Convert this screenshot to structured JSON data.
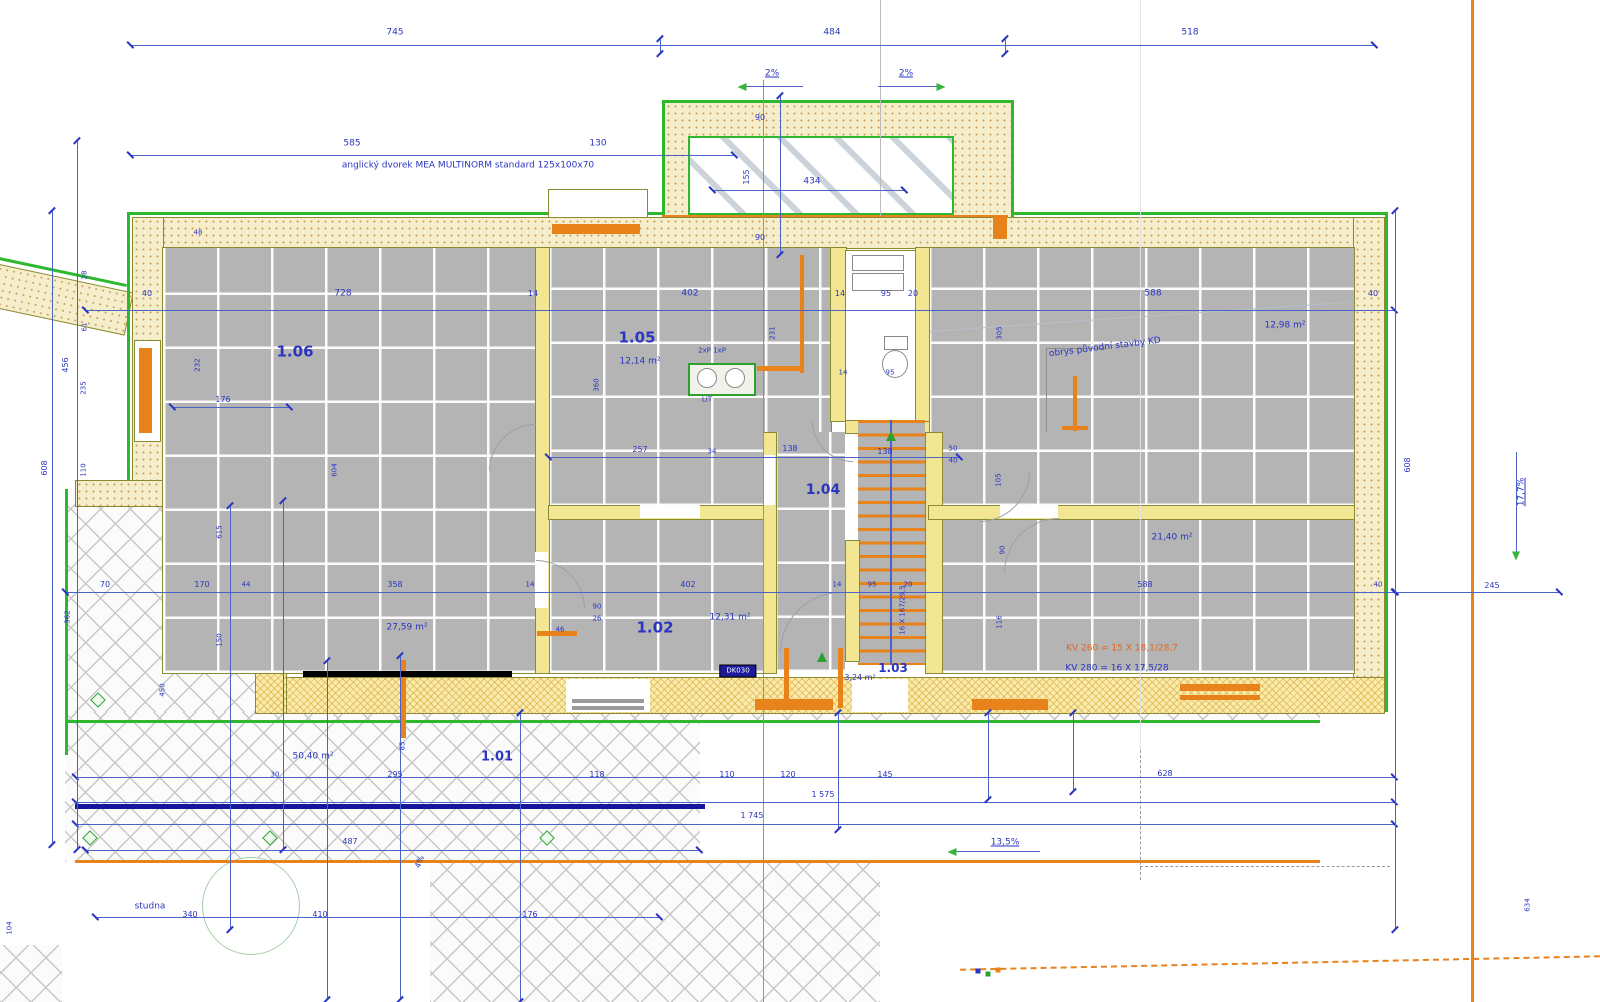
{
  "title": "Floor plan – ground floor (1.NP) with site dimensions",
  "colors": {
    "dimension_blue": "#2a35c0",
    "line_blue": "#4a63c8",
    "outline_green": "#2db82d",
    "window_orange": "#e8821a",
    "badge_navy": "#1b1b99",
    "wall_tan": "#f6edcb",
    "floor_gray": "#b4b4b4"
  },
  "rooms": [
    {
      "number": "1.01",
      "area": "50,40 m²"
    },
    {
      "number": "1.02",
      "area": "12,31 m²"
    },
    {
      "number": "1.03",
      "area": "3,24 m²"
    },
    {
      "number": "1.04",
      "area": ""
    },
    {
      "number": "1.05",
      "area": "12,14 m²"
    },
    {
      "number": "1.06",
      "area": "27,59 m²"
    }
  ],
  "labels": [
    {
      "t": "745",
      "x": 395,
      "y": 33,
      "name": "dim-745"
    },
    {
      "t": "484",
      "x": 832,
      "y": 33,
      "name": "dim-484"
    },
    {
      "t": "518",
      "x": 1190,
      "y": 33,
      "name": "dim-518"
    },
    {
      "t": "2%",
      "x": 772,
      "y": 74,
      "u": 1,
      "name": "slope-2pct-left"
    },
    {
      "t": "2%",
      "x": 906,
      "y": 74,
      "u": 1,
      "name": "slope-2pct-right"
    },
    {
      "t": "585",
      "x": 352,
      "y": 144
    },
    {
      "t": "130",
      "x": 598,
      "y": 144
    },
    {
      "t": "anglický dvorek MEA MULTINORM standard 125x100x70",
      "x": 468,
      "y": 166,
      "s": 9,
      "name": "note-english-area"
    },
    {
      "t": "90",
      "x": 760,
      "y": 118,
      "s": 8
    },
    {
      "t": "434",
      "x": 812,
      "y": 182
    },
    {
      "t": "155",
      "x": 747,
      "y": 177,
      "r": -90,
      "s": 8
    },
    {
      "t": "90",
      "x": 760,
      "y": 238,
      "s": 8
    },
    {
      "t": "48",
      "x": 198,
      "y": 233,
      "s": 7
    },
    {
      "t": "40",
      "x": 147,
      "y": 294,
      "s": 8
    },
    {
      "t": "728",
      "x": 343,
      "y": 294
    },
    {
      "t": "14",
      "x": 533,
      "y": 294,
      "s": 8
    },
    {
      "t": "402",
      "x": 690,
      "y": 294
    },
    {
      "t": "14",
      "x": 840,
      "y": 294,
      "s": 8
    },
    {
      "t": "95",
      "x": 886,
      "y": 294,
      "s": 8
    },
    {
      "t": "20",
      "x": 913,
      "y": 294,
      "s": 8
    },
    {
      "t": "588",
      "x": 1153,
      "y": 294
    },
    {
      "t": "40",
      "x": 1373,
      "y": 294,
      "s": 8
    },
    {
      "t": "12,98 m²",
      "x": 1285,
      "y": 326,
      "s": 9,
      "name": "area-right-top"
    },
    {
      "t": "obrys původní stavby KD",
      "x": 1105,
      "y": 348,
      "r": -7,
      "s": 9,
      "name": "note-original-building"
    },
    {
      "t": "28",
      "x": 85,
      "y": 275,
      "r": -90,
      "s": 7
    },
    {
      "t": "61",
      "x": 85,
      "y": 327,
      "r": -90,
      "s": 7
    },
    {
      "t": "235",
      "x": 84,
      "y": 388,
      "r": -90,
      "s": 7
    },
    {
      "t": "110",
      "x": 84,
      "y": 470,
      "r": -90,
      "s": 7
    },
    {
      "t": "456",
      "x": 66,
      "y": 365,
      "r": -90,
      "s": 8
    },
    {
      "t": "608",
      "x": 45,
      "y": 468,
      "r": -90,
      "s": 8
    },
    {
      "t": "232",
      "x": 198,
      "y": 365,
      "r": -90,
      "s": 7
    },
    {
      "t": "176",
      "x": 223,
      "y": 400,
      "s": 8
    },
    {
      "t": "604",
      "x": 335,
      "y": 470,
      "r": -90,
      "s": 7
    },
    {
      "t": "1.06",
      "x": 295,
      "y": 352,
      "b": 1,
      "s": 15,
      "name": "room-number-1-06"
    },
    {
      "t": "1.05",
      "x": 637,
      "y": 338,
      "b": 1,
      "s": 15,
      "name": "room-number-1-05"
    },
    {
      "t": "12,14 m²",
      "x": 640,
      "y": 362,
      "s": 9,
      "name": "area-1-05"
    },
    {
      "t": "2xP 1xP",
      "x": 712,
      "y": 351,
      "s": 7
    },
    {
      "t": "LIT",
      "x": 707,
      "y": 400,
      "s": 7
    },
    {
      "t": "257",
      "x": 640,
      "y": 450,
      "s": 8
    },
    {
      "t": "34",
      "x": 712,
      "y": 452,
      "s": 7
    },
    {
      "t": "138",
      "x": 790,
      "y": 449,
      "s": 8
    },
    {
      "t": "138",
      "x": 885,
      "y": 452,
      "s": 8
    },
    {
      "t": "360",
      "x": 597,
      "y": 385,
      "r": -90,
      "s": 7
    },
    {
      "t": "231",
      "x": 773,
      "y": 333,
      "r": -90,
      "s": 7
    },
    {
      "t": "95",
      "x": 890,
      "y": 373,
      "s": 7
    },
    {
      "t": "14",
      "x": 843,
      "y": 373,
      "s": 7
    },
    {
      "t": "1.04",
      "x": 823,
      "y": 490,
      "b": 1,
      "s": 14,
      "name": "room-number-1-04"
    },
    {
      "t": "50",
      "x": 953,
      "y": 449,
      "s": 7
    },
    {
      "t": "40",
      "x": 953,
      "y": 461,
      "s": 7
    },
    {
      "t": "305",
      "x": 1000,
      "y": 333,
      "r": -90,
      "s": 7
    },
    {
      "t": "105",
      "x": 999,
      "y": 480,
      "r": -90,
      "s": 7
    },
    {
      "t": "90",
      "x": 1003,
      "y": 550,
      "r": -90,
      "s": 7
    },
    {
      "t": "116",
      "x": 1000,
      "y": 622,
      "r": -90,
      "s": 7
    },
    {
      "t": "21,40 m²",
      "x": 1172,
      "y": 538,
      "s": 9,
      "name": "area-right-bottom"
    },
    {
      "t": "16 X 167/29,5",
      "x": 903,
      "y": 610,
      "r": -90,
      "s": 7,
      "name": "stair-spec"
    },
    {
      "t": "1.02",
      "x": 655,
      "y": 628,
      "b": 1,
      "s": 15,
      "name": "room-number-1-02"
    },
    {
      "t": "12,31 m²",
      "x": 730,
      "y": 618,
      "s": 9,
      "name": "area-1-02"
    },
    {
      "t": "46",
      "x": 560,
      "y": 630,
      "s": 7
    },
    {
      "t": "90",
      "x": 597,
      "y": 607,
      "s": 7
    },
    {
      "t": "26",
      "x": 597,
      "y": 619,
      "s": 7
    },
    {
      "t": "1.03",
      "x": 893,
      "y": 668,
      "b": 1,
      "s": 12,
      "name": "room-number-1-03"
    },
    {
      "t": "3,24 m²",
      "x": 860,
      "y": 678,
      "s": 8,
      "name": "area-1-03"
    },
    {
      "t": "KV 260 = 15 X 18,1/28,7",
      "x": 1122,
      "y": 649,
      "s": 9,
      "c": "orange-t",
      "name": "stair-note-orange"
    },
    {
      "t": "KV 280 = 16 X 17,5/28",
      "x": 1117,
      "y": 669,
      "s": 9,
      "name": "stair-note-blue"
    },
    {
      "t": "70",
      "x": 105,
      "y": 585,
      "s": 8
    },
    {
      "t": "170",
      "x": 202,
      "y": 585,
      "s": 8
    },
    {
      "t": "44",
      "x": 246,
      "y": 585,
      "s": 7
    },
    {
      "t": "358",
      "x": 395,
      "y": 585,
      "s": 8
    },
    {
      "t": "14",
      "x": 530,
      "y": 585,
      "s": 7
    },
    {
      "t": "402",
      "x": 688,
      "y": 585,
      "s": 8
    },
    {
      "t": "14",
      "x": 837,
      "y": 585,
      "s": 7
    },
    {
      "t": "95",
      "x": 872,
      "y": 585,
      "s": 7
    },
    {
      "t": "20",
      "x": 908,
      "y": 585,
      "s": 7
    },
    {
      "t": "588",
      "x": 1145,
      "y": 585,
      "s": 8
    },
    {
      "t": "40",
      "x": 1378,
      "y": 585,
      "s": 7
    },
    {
      "t": "245",
      "x": 1492,
      "y": 586,
      "s": 8
    },
    {
      "t": "27,59 m²",
      "x": 407,
      "y": 628,
      "s": 9,
      "name": "area-1-06"
    },
    {
      "t": "362",
      "x": 68,
      "y": 617,
      "r": -90,
      "s": 7
    },
    {
      "t": "450",
      "x": 163,
      "y": 690,
      "r": -90,
      "s": 7
    },
    {
      "t": "615",
      "x": 220,
      "y": 532,
      "r": -90,
      "s": 7
    },
    {
      "t": "150",
      "x": 220,
      "y": 640,
      "r": -90,
      "s": 7
    },
    {
      "t": "1.01",
      "x": 497,
      "y": 757,
      "b": 1,
      "s": 13,
      "name": "room-number-1-01"
    },
    {
      "t": "50,40 m²",
      "x": 313,
      "y": 757,
      "s": 9,
      "name": "area-1-01"
    },
    {
      "t": "85",
      "x": 403,
      "y": 746,
      "r": -90,
      "s": 7
    },
    {
      "t": "30",
      "x": 275,
      "y": 775,
      "s": 7
    },
    {
      "t": "295",
      "x": 395,
      "y": 775,
      "s": 8
    },
    {
      "t": "118",
      "x": 597,
      "y": 775,
      "s": 8
    },
    {
      "t": "110",
      "x": 727,
      "y": 775,
      "s": 8
    },
    {
      "t": "120",
      "x": 788,
      "y": 775,
      "s": 8
    },
    {
      "t": "145",
      "x": 885,
      "y": 775,
      "s": 8
    },
    {
      "t": "628",
      "x": 1165,
      "y": 774,
      "s": 8
    },
    {
      "t": "1 575",
      "x": 823,
      "y": 795,
      "s": 8
    },
    {
      "t": "1 745",
      "x": 752,
      "y": 816,
      "s": 8
    },
    {
      "t": "13,5%",
      "x": 1005,
      "y": 843,
      "u": 1,
      "name": "slope-13-5pct"
    },
    {
      "t": "487",
      "x": 350,
      "y": 842,
      "s": 8
    },
    {
      "t": "4%",
      "x": 420,
      "y": 862,
      "r": -70,
      "s": 8,
      "name": "slope-4pct"
    },
    {
      "t": "studna",
      "x": 150,
      "y": 907,
      "s": 9,
      "name": "note-well"
    },
    {
      "t": "340",
      "x": 190,
      "y": 915,
      "s": 8
    },
    {
      "t": "410",
      "x": 320,
      "y": 915,
      "s": 8
    },
    {
      "t": "176",
      "x": 530,
      "y": 915,
      "s": 8
    },
    {
      "t": "104",
      "x": 10,
      "y": 928,
      "r": -90,
      "s": 7
    },
    {
      "t": "634",
      "x": 1528,
      "y": 905,
      "r": -90,
      "s": 7
    },
    {
      "t": "17,7%",
      "x": 1522,
      "y": 492,
      "r": -90,
      "u": 1,
      "name": "slope-17-7pct"
    },
    {
      "t": "608",
      "x": 1408,
      "y": 465,
      "r": -90,
      "s": 8
    },
    {
      "t": "DK030",
      "x": 738,
      "y": 671,
      "badge": 1,
      "name": "element-badge"
    }
  ],
  "markers": [
    {
      "type": "diamond",
      "x": 98,
      "y": 700
    },
    {
      "type": "diamond",
      "x": 90,
      "y": 838
    },
    {
      "type": "diamond",
      "x": 270,
      "y": 838
    },
    {
      "type": "diamond",
      "x": 547,
      "y": 838
    },
    {
      "type": "arrow-left",
      "x": 742,
      "y": 87
    },
    {
      "type": "arrow-right",
      "x": 941,
      "y": 87
    },
    {
      "type": "arrow-left",
      "x": 952,
      "y": 852
    },
    {
      "type": "arrow-down",
      "x": 1516,
      "y": 556
    },
    {
      "type": "tri-up",
      "x": 891,
      "y": 436
    },
    {
      "type": "tri-up",
      "x": 822,
      "y": 657
    },
    {
      "type": "dot",
      "x": 978,
      "y": 971,
      "c": "#2a35c0"
    },
    {
      "type": "dot",
      "x": 988,
      "y": 974,
      "c": "#2da02d"
    },
    {
      "type": "dot",
      "x": 998,
      "y": 970,
      "c": "#e8821a"
    }
  ]
}
